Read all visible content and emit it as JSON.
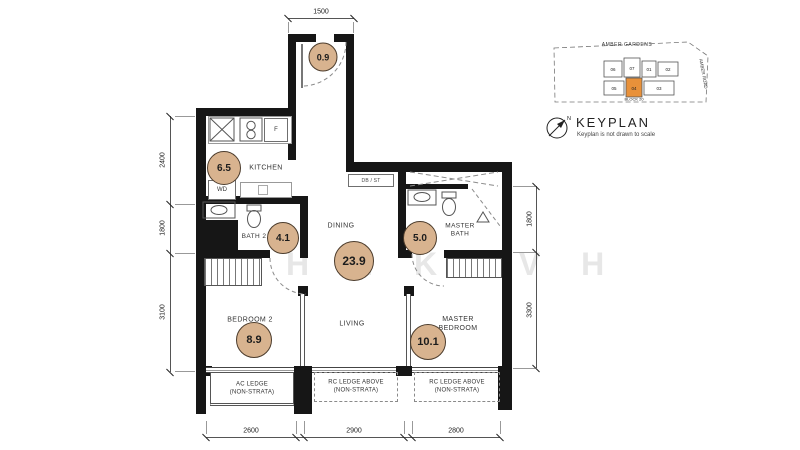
{
  "colors": {
    "wall": "#161616",
    "area_circle_fill": "#d8b38f",
    "keyplan_highlight": "#e8913a"
  },
  "watermark": "H N K OV H",
  "plan": {
    "rooms": [
      {
        "name": "entry",
        "area": "0.9"
      },
      {
        "name": "kitchen",
        "label": "KITCHEN",
        "area": "6.5"
      },
      {
        "name": "bath-2",
        "label": "BATH 2",
        "area": "4.1"
      },
      {
        "name": "dining",
        "label": "DINING",
        "area": "23.9"
      },
      {
        "name": "master-bath",
        "label": "MASTER BATH",
        "area": "5.0"
      },
      {
        "name": "bedroom-2",
        "label": "BEDROOM 2",
        "area": "8.9"
      },
      {
        "name": "living",
        "label": "LIVING"
      },
      {
        "name": "master-bedroom",
        "label": "MASTER BEDROOM",
        "area": "10.1"
      }
    ],
    "fixtures": {
      "fridge": "F",
      "washer_dryer": "WD",
      "db_st": "DB / ST"
    },
    "ledges": [
      {
        "label": "AC LEDGE",
        "sub": "(NON-STRATA)"
      },
      {
        "label": "RC LEDGE ABOVE",
        "sub": "(NON-STRATA)"
      },
      {
        "label": "RC LEDGE ABOVE",
        "sub": "(NON-STRATA)"
      }
    ],
    "dimensions": {
      "top": [
        "1500"
      ],
      "left": [
        "2400",
        "1800",
        "3100"
      ],
      "right": [
        "1800",
        "3300"
      ],
      "bottom": [
        "2600",
        "2900",
        "2800"
      ]
    }
  },
  "keyplan": {
    "title": "KEYPLAN",
    "note": "Keyplan is not drawn to scale",
    "street_top": "AMBER GARDENS",
    "street_right": "AMBER ROAD",
    "block_label": "BLOCK 20",
    "units_top": [
      "06",
      "07",
      "01",
      "02"
    ],
    "units_bottom": [
      "05",
      "04",
      "03"
    ],
    "highlighted_unit": "04"
  }
}
